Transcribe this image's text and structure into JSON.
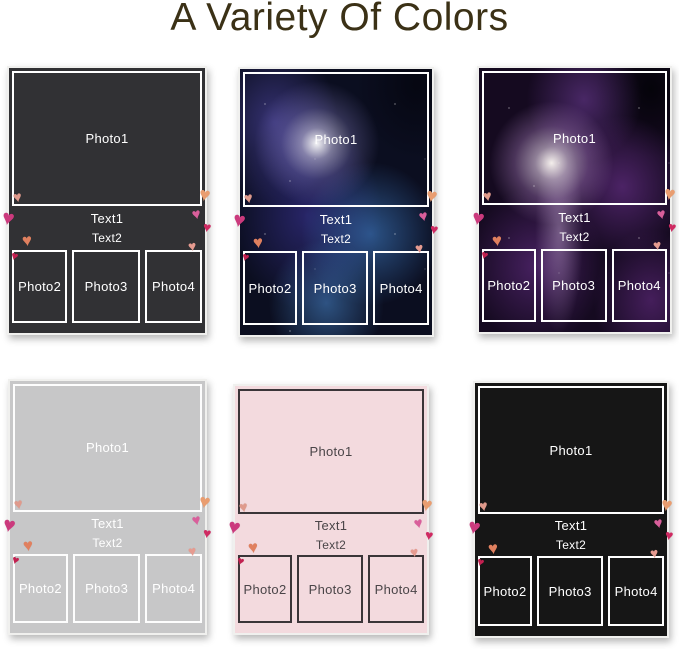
{
  "title": {
    "text": "A Variety Of Colors",
    "color": "#3b3116"
  },
  "icons": {
    "heart": "♥"
  },
  "labels": {
    "photo1": "Photo1",
    "text1": "Text1",
    "text2": "Text2",
    "photo2": "Photo2",
    "photo3": "Photo3",
    "photo4": "Photo4"
  },
  "cards": [
    {
      "name": "dark-gray-blanket",
      "variant": "solid",
      "background": "#313134",
      "text_color": "#ffffff",
      "border_color": "#ffffff"
    },
    {
      "name": "blue-galaxy-blanket",
      "variant": "galaxy-blue",
      "background": "#0b0e20",
      "text_color": "#ffffff",
      "border_color": "#ffffff"
    },
    {
      "name": "purple-galaxy-blanket",
      "variant": "galaxy-purple",
      "background": "#150a20",
      "text_color": "#ffffff",
      "border_color": "#ffffff"
    },
    {
      "name": "light-gray-blanket",
      "variant": "solid",
      "background": "#c7c7c8",
      "text_color": "#ffffff",
      "border_color": "#fdfdfd"
    },
    {
      "name": "pink-blanket",
      "variant": "solid",
      "background": "#f3dade",
      "text_color": "#4a4548",
      "border_color": "#3a3538"
    },
    {
      "name": "black-blanket",
      "variant": "solid",
      "background": "#161616",
      "text_color": "#ffffff",
      "border_color": "#ffffff"
    }
  ],
  "hearts": [
    {
      "name": "heart-left-top",
      "color": "#df9a8c"
    },
    {
      "name": "heart-left-mid",
      "color": "#cb3a7d"
    },
    {
      "name": "heart-left-coral",
      "color": "#e0805f"
    },
    {
      "name": "heart-left-small",
      "color": "#c22050"
    },
    {
      "name": "heart-right-top",
      "color": "#e99d70"
    },
    {
      "name": "heart-right-pink",
      "color": "#d95f9b"
    },
    {
      "name": "heart-right-deep",
      "color": "#cf2a62"
    },
    {
      "name": "heart-right-pale",
      "color": "#e69b90"
    }
  ]
}
